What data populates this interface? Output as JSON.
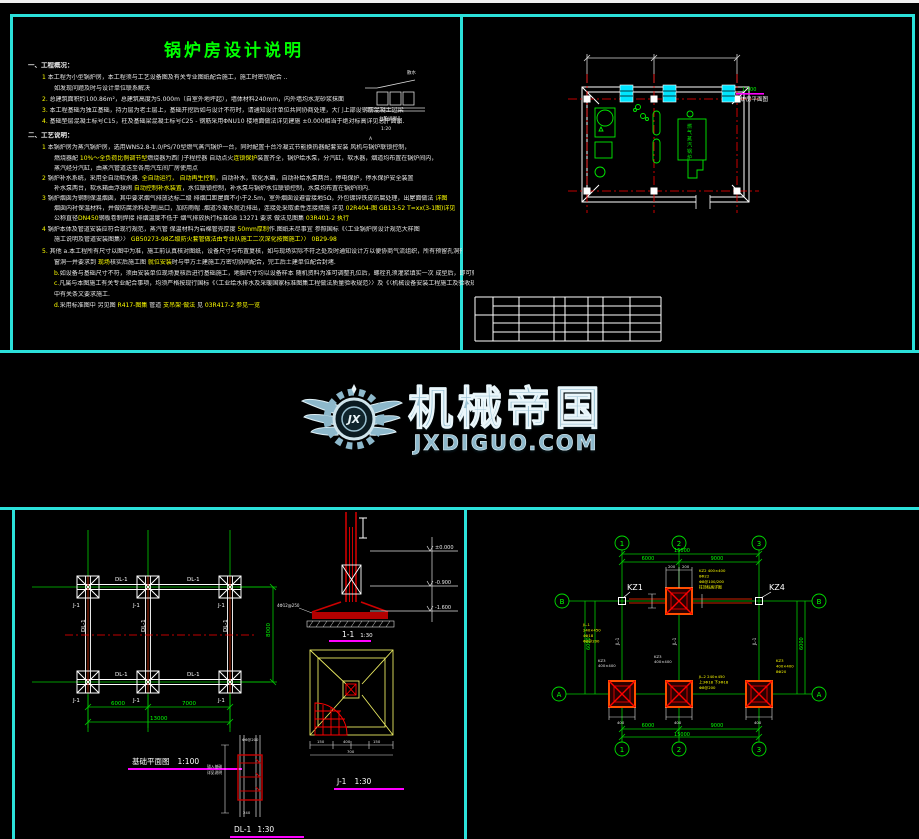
{
  "colors": {
    "panel_border": "#2be0da",
    "title_green": "#00ff00",
    "body_white": "#e8e8e8",
    "highlight_yellow": "#ffff00",
    "axis_red": "#ff0000",
    "equip_green": "#00ee00",
    "window_cyan": "#00e5ff",
    "dim_green": "#00cc00",
    "caption_magenta": "#ff00ff",
    "logo_blue": "#9cc2d3"
  },
  "logo": {
    "brand": "机械帝国",
    "domain": "JXDIGUO.COM",
    "mono": "JX"
  },
  "notes": {
    "title": "锅炉房设计说明",
    "inset": {
      "t1": "台阶详图",
      "t2": "1:20",
      "t3": "散水",
      "t4": "A"
    },
    "lines": [
      {
        "x": 18,
        "y": 48,
        "h": 1,
        "seg": [
          [
            "w",
            "一、工程概况："
          ]
        ]
      },
      {
        "x": 32,
        "y": 60,
        "seg": [
          [
            "y",
            "1"
          ],
          [
            "w",
            " 本工程为小型锅炉房，本工程须与工艺设备图及有关专业图纸配合施工，施工时密切配合 .."
          ]
        ]
      },
      {
        "x": 44,
        "y": 71,
        "seg": [
          [
            "w",
            "如发现问题及时与设计单位联系解决"
          ]
        ]
      },
      {
        "x": 32,
        "y": 82,
        "seg": [
          [
            "y",
            "2."
          ],
          [
            "w",
            " 总建筑面积约100.86m²，总建筑高度为5.000m（自室外地坪起），墙体材料240mm，内外墙均水泥砂浆抹面"
          ]
        ]
      },
      {
        "x": 32,
        "y": 93,
        "seg": [
          [
            "y",
            "3."
          ],
          [
            "w",
            " 本工程基础为独立基础，持力层为老土层上，基础开挖后如与设计不符时，请通知设计单位共同协商处理，大门上部设钢筋混凝土过梁"
          ]
        ]
      },
      {
        "x": 32,
        "y": 104,
        "seg": [
          [
            "y",
            "4."
          ],
          [
            "w",
            " 基础垫层混凝土标号C15，柱及基础梁混凝土标号C25 - 钢筋采用ΦNU10 楼地面做法详见建施 ±0.000相当于绝对标高详见总平面图."
          ]
        ]
      },
      {
        "x": 18,
        "y": 118,
        "h": 1,
        "seg": [
          [
            "w",
            "二、工艺说明："
          ]
        ]
      },
      {
        "x": 32,
        "y": 130,
        "seg": [
          [
            "y",
            "1"
          ],
          [
            "w",
            " 本锅炉房为蒸汽锅炉房，选用WNS2.8-1.0/PS/70型燃气蒸汽锅炉一台，同时配置十台冷凝式节能换热器配套安装 风机与锅炉联锁控制，"
          ]
        ]
      },
      {
        "x": 44,
        "y": 141,
        "seg": [
          [
            "w",
            "燃烧器配 "
          ],
          [
            "y",
            "10%～全负荷比例调节型"
          ],
          [
            "w",
            "燃烧器为西门子程控器 "
          ],
          [
            "w",
            "自动点火"
          ],
          [
            "y",
            "连锁保护"
          ],
          [
            "w",
            "装置齐全，锅炉给水泵，分汽缸，软水器，烟道均布置在锅炉间内，"
          ]
        ]
      },
      {
        "x": 44,
        "y": 151,
        "seg": [
          [
            "w",
            "蒸汽经分汽缸，由蒸汽管道送至各用汽车间厂房使用点"
          ]
        ]
      },
      {
        "x": 32,
        "y": 161,
        "seg": [
          [
            "y",
            "2"
          ],
          [
            "w",
            " 锅炉补水系统，采用全自动软水器. "
          ],
          [
            "y",
            "全自动运行，"
          ],
          [
            "w",
            " "
          ],
          [
            "y",
            "自动再生控制"
          ],
          [
            "w",
            "，自动补水，软化水箱，自动补给水泵两台，停电保护，停水保护安全装置"
          ]
        ]
      },
      {
        "x": 44,
        "y": 171,
        "seg": [
          [
            "w",
            "补水泵两台，软水箱由浮球阀 "
          ],
          [
            "y",
            "自动控制补水装置"
          ],
          [
            "w",
            "，水位联锁控制，补水泵与锅炉水位联锁控制，水泵均布置在锅炉间内."
          ]
        ]
      },
      {
        "x": 32,
        "y": 181,
        "seg": [
          [
            "y",
            "3"
          ],
          [
            "w",
            " 锅炉烟囱为钢制保温烟囱，其中要求烟气排放达标二级 排烟口距屋面不小于2.5m，室外烟囱设避雷接地5Ω，外包镀锌铁皮防腐处理，出屋面做法 "
          ],
          [
            "y",
            "详图"
          ]
        ]
      },
      {
        "x": 44,
        "y": 191,
        "seg": [
          [
            "w",
            "烟囱内衬保温材料，并做防腐涂料处理|出口，加防雨帽 .烟道冷凝水就近排出，连接处采取柔性连接措施 详见 "
          ],
          [
            "y",
            "02R404-图 GB13-52 T=xx(3-1图)详见"
          ]
        ]
      },
      {
        "x": 44,
        "y": 201,
        "seg": [
          [
            "w",
            "公称直径"
          ],
          [
            "y",
            "DN450"
          ],
          [
            "w",
            "钢板卷制焊接  排烟温度不低于 烟气排放执行标准GB 13271 要求       做法见图集 "
          ],
          [
            "y",
            "03R401-2 执行"
          ]
        ]
      },
      {
        "x": 32,
        "y": 212,
        "seg": [
          [
            "y",
            "4"
          ],
          [
            "w",
            " 锅炉本体及管道安装应符合现行规范，蒸汽管 保温材料为岩棉管壳厚度 "
          ],
          [
            "y",
            "50mm厚制"
          ],
          [
            "w",
            "作.图纸未尽事宜  参照国标《〈工业锅炉房设计规范大样图"
          ]
        ]
      },
      {
        "x": 44,
        "y": 222,
        "seg": [
          [
            "w",
            "施工说明及管道安装图集〉〉 "
          ],
          [
            "y",
            "GB50273-98乙级防火套管做法由专业队施工二次深化按图施工〉〉"
          ],
          [
            "w",
            "     "
          ],
          [
            "y",
            "0B29-98"
          ]
        ]
      },
      {
        "x": 32,
        "y": 234,
        "seg": [
          [
            "y",
            "5."
          ],
          [
            "w",
            " 其他 a.本工程所有尺寸以图中为准，施工前认真核对图纸，设备尺寸与布置复核，如与现场实际不符之处及时通知设计方以便协商气流组织，所有预留孔洞预埋件门"
          ]
        ]
      },
      {
        "x": 44,
        "y": 245,
        "seg": [
          [
            "w",
            "窗洞一并要求到 "
          ],
          [
            "y",
            "现场"
          ],
          [
            "w",
            "核实后施工图 "
          ],
          [
            "y",
            "就位安装"
          ],
          [
            "w",
            "时与甲方土建施工方密切协同配合，完工后土建单位配合封堵."
          ]
        ]
      },
      {
        "x": 44,
        "y": 256,
        "seg": [
          [
            "y",
            "b."
          ],
          [
            "w",
            "如设备与基础尺寸不符，须由安装单位现场复核后进行基础施工，地脚尺寸均以设备样本 随机资料为准可调整孔位后，螺栓孔须灌浆填实一次 成型后，即可就位."
          ]
        ]
      },
      {
        "x": 44,
        "y": 266,
        "seg": [
          [
            "y",
            "c."
          ],
          [
            "w",
            "凡属与本图施工有关专业配合事项，均须严格按现行国标《〈工业给水排水及采暖国家标准图集工程做法质量验收规范〉〉及《〈机械设备安装工程施工及验收规范〉〉"
          ]
        ]
      },
      {
        "x": 44,
        "y": 277,
        "seg": [
          [
            "w",
            "中有关条文要求施工."
          ]
        ]
      },
      {
        "x": 44,
        "y": 288,
        "seg": [
          [
            "y",
            "d."
          ],
          [
            "w",
            "采用标准图中  另见图 "
          ],
          [
            "y",
            "R417-图集"
          ],
          [
            "w",
            "  管道 "
          ],
          [
            "y",
            "支吊架·做法 "
          ],
          [
            "w",
            "见 "
          ],
          [
            "y",
            "03R417-2"
          ],
          [
            "w",
            "     "
          ],
          [
            "y",
            "参见一览"
          ]
        ]
      }
    ]
  },
  "fp": {
    "lab_g": "1:100",
    "lab_w": "锅炉房平面图",
    "boiler": "燃气蒸汽锅炉"
  },
  "fd": {
    "beam": "DL-1",
    "foot": "J-1",
    "d1": "6000",
    "d2": "7000",
    "d3": "13000",
    "d4": "8000",
    "cap": "基础平面图",
    "cap_s": "1:100",
    "sec_cap": "1-1",
    "sec_s": "1:30",
    "e0": "±0.000",
    "e1": "-0.900",
    "e2": "-1.600",
    "rebar": "4Φ12@250",
    "j_cap": "J-1",
    "j_s": "1:30",
    "jd1": "150",
    "jd2": "400",
    "jd3": "150",
    "jd4": "700",
    "b_cap": "DL-1",
    "b_s": "1:30",
    "b_t": "Φ6@200",
    "b_d": "240",
    "b_n1": "锚入基础",
    "b_n2": "详见说明"
  },
  "cp": {
    "g1": "1",
    "g2": "2",
    "g3": "3",
    "ga": "A",
    "gb": "B",
    "total": "15000",
    "s1": "6000",
    "s2": "9000",
    "v": "6000",
    "kz1": "KZ1",
    "kz4": "KZ4",
    "d200": "200",
    "d400": "400",
    "a1": [
      "KZ2 400×400",
      "8Φ22",
      "Φ8@100/200",
      "柱顶标高详图"
    ],
    "a2": [
      "JL-1",
      "240×450",
      "4Φ18",
      "Φ8@200"
    ],
    "a3": [
      "JL-2 240×450",
      "上3Φ18 下3Φ18",
      "Φ8@200"
    ],
    "a4": [
      "KZ3",
      "400×400",
      "8Φ20"
    ],
    "w1": "KZ3",
    "w2": "400×400",
    "jl": "JL-1"
  }
}
